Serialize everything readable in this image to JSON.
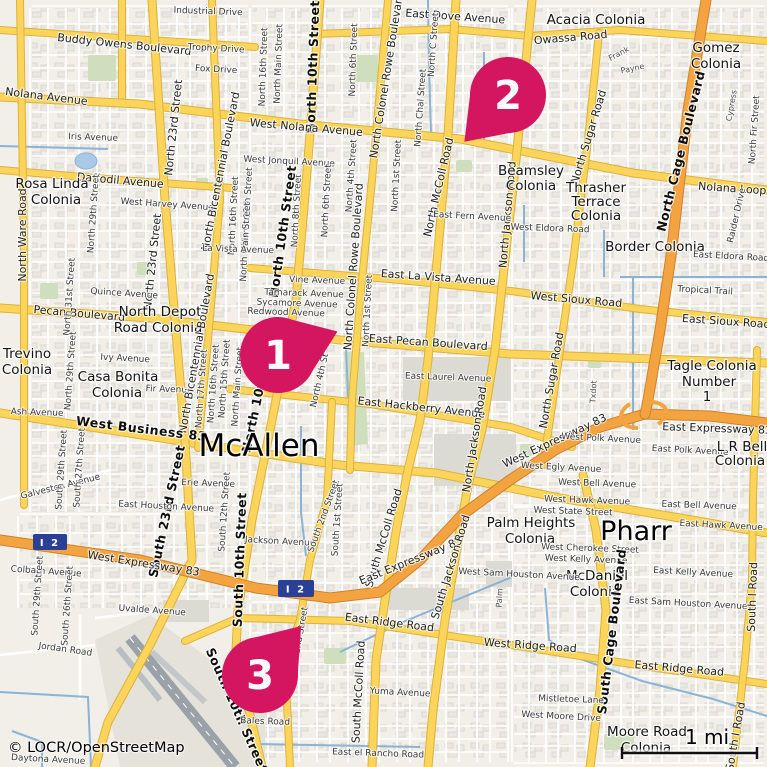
{
  "map": {
    "attribution": "© LOCR/OpenStreetMap",
    "scale_label": "1 mi",
    "shield_label": "I 2",
    "cities": [
      "McAllen",
      "Pharr"
    ],
    "markers": [
      {
        "label": "1"
      },
      {
        "label": "2"
      },
      {
        "label": "3"
      }
    ],
    "colors": {
      "marker": "#d4155f",
      "road_yellow": "#fcd45a",
      "road_orange": "#f3a440",
      "water": "#8ab3d6",
      "park": "#cfdfbe",
      "shield_blue": "#2a3f96",
      "land": "#f2efe9"
    },
    "labels": [
      {
        "t": "Industrial Drive",
        "x": 208,
        "y": 14,
        "r": 2
      },
      {
        "t": "Buddy Owens Boulevard",
        "x": 124,
        "y": 48,
        "r": 6,
        "k": "road"
      },
      {
        "t": "Trophy Drive",
        "x": 216,
        "y": 51,
        "r": 3
      },
      {
        "t": "Fox Drive",
        "x": 216,
        "y": 72,
        "r": 3
      },
      {
        "t": "Nolana Avenue",
        "x": 46,
        "y": 100,
        "r": 7,
        "k": "road"
      },
      {
        "t": "Iris Avenue",
        "x": 93,
        "y": 140,
        "r": 2
      },
      {
        "t": "Daffodil Avenue",
        "x": 120,
        "y": 184,
        "r": 5,
        "k": "road"
      },
      {
        "t": "Rosa Linda",
        "x": 52,
        "y": 188,
        "k": "colonia"
      },
      {
        "t": "Colonia",
        "x": 56,
        "y": 204,
        "k": "colonia"
      },
      {
        "t": "West Harvey Avenue",
        "x": 167,
        "y": 207,
        "r": 4
      },
      {
        "t": "North Ware Road",
        "x": 26,
        "y": 235,
        "r": -90,
        "k": "road"
      },
      {
        "t": "North 29th Street",
        "x": 96,
        "y": 214,
        "r": -86
      },
      {
        "t": "North 23rd Street",
        "x": 177,
        "y": 128,
        "r": -84,
        "k": "road"
      },
      {
        "t": "North 23rd Street",
        "x": 156,
        "y": 262,
        "r": -84,
        "k": "road"
      },
      {
        "t": "North Bicentennial Boulevard",
        "x": 224,
        "y": 172,
        "r": -79,
        "k": "road"
      },
      {
        "t": "North 16th Street",
        "x": 266,
        "y": 67,
        "r": -88
      },
      {
        "t": "North Main Street",
        "x": 281,
        "y": 64,
        "r": -88
      },
      {
        "t": "North 10th Street",
        "x": 317,
        "y": 67,
        "r": -88,
        "k": "bold"
      },
      {
        "t": "North 6th Street",
        "x": 356,
        "y": 60,
        "r": -88
      },
      {
        "t": "North Colonel Rowe Boulevard",
        "x": 390,
        "y": 76,
        "r": -81,
        "k": "road"
      },
      {
        "t": "East Dove Avenue",
        "x": 455,
        "y": 20,
        "r": 4,
        "k": "road"
      },
      {
        "t": "North C Street",
        "x": 436,
        "y": 45,
        "r": -86
      },
      {
        "t": "North Chal Street",
        "x": 423,
        "y": 108,
        "r": -86
      },
      {
        "t": "North McColl Road",
        "x": 442,
        "y": 188,
        "r": -77,
        "k": "road"
      },
      {
        "t": "Acacia Colonia",
        "x": 596,
        "y": 24,
        "k": "colonia"
      },
      {
        "t": "Owassa Road",
        "x": 571,
        "y": 41,
        "r": -5,
        "k": "road"
      },
      {
        "t": "Gomez",
        "x": 716,
        "y": 52,
        "k": "colonia"
      },
      {
        "t": "Colonia",
        "x": 716,
        "y": 68,
        "k": "colonia"
      },
      {
        "t": "Frank",
        "x": 620,
        "y": 56,
        "r": -28,
        "k": "small"
      },
      {
        "t": "Payne",
        "x": 633,
        "y": 71,
        "r": -12,
        "k": "small"
      },
      {
        "t": "North Cage Boulevard",
        "x": 685,
        "y": 152,
        "r": -76,
        "k": "bold"
      },
      {
        "t": "Cypress",
        "x": 734,
        "y": 106,
        "r": -80,
        "k": "small"
      },
      {
        "t": "North Fir Street",
        "x": 757,
        "y": 130,
        "r": -86
      },
      {
        "t": "North Sugar Road",
        "x": 592,
        "y": 138,
        "r": -73,
        "k": "road"
      },
      {
        "t": "North Jackson Road",
        "x": 511,
        "y": 215,
        "r": -85,
        "k": "road"
      },
      {
        "t": "West Nolana Avenue",
        "x": 306,
        "y": 131,
        "r": 5,
        "k": "road"
      },
      {
        "t": "West Jonquil Avenue",
        "x": 289,
        "y": 164,
        "r": 3
      },
      {
        "t": "North 12th Street",
        "x": 250,
        "y": 207,
        "r": -87
      },
      {
        "t": "North 16th Street",
        "x": 236,
        "y": 216,
        "r": -87
      },
      {
        "t": "North Main Street",
        "x": 248,
        "y": 242,
        "r": -87
      },
      {
        "t": "North 8th Street",
        "x": 299,
        "y": 211,
        "r": -87
      },
      {
        "t": "North 6th Street",
        "x": 329,
        "y": 201,
        "r": -87
      },
      {
        "t": "North 4th Street",
        "x": 354,
        "y": 176,
        "r": -86
      },
      {
        "t": "North 1st Street",
        "x": 399,
        "y": 176,
        "r": -87
      },
      {
        "t": "North 10th Street",
        "x": 287,
        "y": 232,
        "r": -82,
        "k": "bold"
      },
      {
        "t": "East Fern Avenue",
        "x": 472,
        "y": 219,
        "r": 3
      },
      {
        "t": "Beamsley",
        "x": 531,
        "y": 175,
        "k": "colonia"
      },
      {
        "t": "Colonia",
        "x": 531,
        "y": 190,
        "k": "colonia"
      },
      {
        "t": "Thrasher",
        "x": 596,
        "y": 192,
        "k": "colonia"
      },
      {
        "t": "Terrace",
        "x": 596,
        "y": 206,
        "k": "colonia"
      },
      {
        "t": "Colonia",
        "x": 596,
        "y": 220,
        "k": "colonia"
      },
      {
        "t": "Nolana Loop",
        "x": 732,
        "y": 192,
        "r": 4,
        "k": "road"
      },
      {
        "t": "Raider Drive",
        "x": 739,
        "y": 216,
        "r": -77
      },
      {
        "t": "West Eldora Road",
        "x": 550,
        "y": 231,
        "r": 2
      },
      {
        "t": "Border Colonia",
        "x": 655,
        "y": 251,
        "k": "colonia"
      },
      {
        "t": "East Eldora Road",
        "x": 731,
        "y": 259,
        "r": 3
      },
      {
        "t": "Tropical Trail",
        "x": 705,
        "y": 293,
        "r": 3
      },
      {
        "t": "La Vista Avenue",
        "x": 238,
        "y": 252,
        "r": 2
      },
      {
        "t": "Vine Avenue",
        "x": 317,
        "y": 283,
        "r": 2
      },
      {
        "t": "Tamarack Avenue",
        "x": 304,
        "y": 296,
        "r": 2
      },
      {
        "t": "Sycamore Avenue",
        "x": 297,
        "y": 306,
        "r": 2
      },
      {
        "t": "Redwood Avenue",
        "x": 286,
        "y": 315,
        "r": 2
      },
      {
        "t": "East La Vista Avenue",
        "x": 438,
        "y": 281,
        "r": 4,
        "k": "road"
      },
      {
        "t": "North 1st Street",
        "x": 370,
        "y": 311,
        "r": -87
      },
      {
        "t": "North Colonel Rowe Boulevard",
        "x": 357,
        "y": 267,
        "r": -86,
        "k": "road"
      },
      {
        "t": "West Sioux Road",
        "x": 576,
        "y": 303,
        "r": 5,
        "k": "road"
      },
      {
        "t": "East Sioux Road",
        "x": 726,
        "y": 325,
        "r": 4,
        "k": "road"
      },
      {
        "t": "North Sugar Road",
        "x": 555,
        "y": 381,
        "r": -80,
        "k": "road"
      },
      {
        "t": "Quince Avenue",
        "x": 124,
        "y": 296,
        "r": 4
      },
      {
        "t": "Pecan Boulevard",
        "x": 79,
        "y": 317,
        "r": 5,
        "k": "road"
      },
      {
        "t": "North Depot",
        "x": 160,
        "y": 316,
        "k": "colonia"
      },
      {
        "t": "Road Colonia",
        "x": 158,
        "y": 332,
        "k": "colonia"
      },
      {
        "t": "North 31st Street",
        "x": 72,
        "y": 297,
        "r": -86
      },
      {
        "t": "Trevino",
        "x": 27,
        "y": 358,
        "k": "colonia"
      },
      {
        "t": "Colonia",
        "x": 27,
        "y": 374,
        "k": "colonia"
      },
      {
        "t": "North 29th Street",
        "x": 73,
        "y": 371,
        "r": -86
      },
      {
        "t": "Casa Bonita",
        "x": 118,
        "y": 381,
        "k": "colonia"
      },
      {
        "t": "Colonia",
        "x": 117,
        "y": 397,
        "k": "colonia"
      },
      {
        "t": "Ivy Avenue",
        "x": 125,
        "y": 361,
        "r": 3
      },
      {
        "t": "Fir Avenue",
        "x": 169,
        "y": 392,
        "r": 2
      },
      {
        "t": "North Bicentennial Boulevard",
        "x": 200,
        "y": 354,
        "r": -80,
        "k": "road"
      },
      {
        "t": "North 17th Street",
        "x": 204,
        "y": 389,
        "r": -86
      },
      {
        "t": "North 16th Street",
        "x": 216,
        "y": 384,
        "r": -86
      },
      {
        "t": "North 15th Street",
        "x": 227,
        "y": 379,
        "r": -86
      },
      {
        "t": "North Main Street",
        "x": 240,
        "y": 387,
        "r": -86
      },
      {
        "t": "North 10th Street",
        "x": 264,
        "y": 388,
        "r": -78,
        "k": "bold"
      },
      {
        "t": "North 4th St",
        "x": 322,
        "y": 381,
        "r": -77
      },
      {
        "t": "East Pecan Boulevard",
        "x": 428,
        "y": 346,
        "r": 4,
        "k": "road"
      },
      {
        "t": "East Laurel Avenue",
        "x": 448,
        "y": 380,
        "r": 2
      },
      {
        "t": "East Hackberry Avenue",
        "x": 421,
        "y": 411,
        "r": 6,
        "k": "road"
      },
      {
        "t": "North Jackson Road",
        "x": 478,
        "y": 440,
        "r": -81,
        "k": "road"
      },
      {
        "t": "Tagle Colonia",
        "x": 712,
        "y": 370,
        "k": "colonia"
      },
      {
        "t": "Number",
        "x": 709,
        "y": 386,
        "k": "colonia"
      },
      {
        "t": "1",
        "x": 707,
        "y": 401,
        "k": "colonia"
      },
      {
        "t": "Txdot",
        "x": 596,
        "y": 392,
        "r": -87,
        "k": "small"
      },
      {
        "t": "Ash Avenue",
        "x": 37,
        "y": 415,
        "r": 2
      },
      {
        "t": "West Business 83",
        "x": 141,
        "y": 433,
        "r": 7,
        "k": "bold"
      },
      {
        "t": "McAllen",
        "x": 259,
        "y": 456,
        "k": "city"
      },
      {
        "t": "Galveston Avenue",
        "x": 61,
        "y": 489,
        "r": -14
      },
      {
        "t": "South 29th Street",
        "x": 64,
        "y": 470,
        "r": -86
      },
      {
        "t": "South 27th Street",
        "x": 82,
        "y": 468,
        "r": -86
      },
      {
        "t": "South 23rd Street",
        "x": 171,
        "y": 512,
        "r": -78,
        "k": "bold"
      },
      {
        "t": "Erie Avenue",
        "x": 208,
        "y": 486,
        "r": 2
      },
      {
        "t": "East Houston Avenue",
        "x": 166,
        "y": 509,
        "r": 3
      },
      {
        "t": "South 12th Street",
        "x": 227,
        "y": 512,
        "r": -86
      },
      {
        "t": "South 10th Street",
        "x": 244,
        "y": 560,
        "r": -88,
        "k": "bold"
      },
      {
        "t": "Jackson Avenue",
        "x": 280,
        "y": 544,
        "r": 3
      },
      {
        "t": "South 2nd Street",
        "x": 326,
        "y": 517,
        "r": -70
      },
      {
        "t": "South 1st Street",
        "x": 340,
        "y": 520,
        "r": -86
      },
      {
        "t": "South McColl Road",
        "x": 387,
        "y": 539,
        "r": -73,
        "k": "road"
      },
      {
        "t": "West Expressway 83",
        "x": 143,
        "y": 567,
        "r": 9,
        "k": "road"
      },
      {
        "t": "East Expressway 83",
        "x": 412,
        "y": 564,
        "r": -22,
        "k": "road"
      },
      {
        "t": "West Expressway 83",
        "x": 556,
        "y": 444,
        "r": -25,
        "k": "road"
      },
      {
        "t": "East Expressway 83",
        "x": 717,
        "y": 432,
        "r": 2,
        "k": "road"
      },
      {
        "t": "West Polk Avenue",
        "x": 601,
        "y": 441,
        "r": 3
      },
      {
        "t": "East Polk Avenue",
        "x": 690,
        "y": 453,
        "r": 3
      },
      {
        "t": "L R Bell",
        "x": 742,
        "y": 451,
        "k": "colonia"
      },
      {
        "t": "Colonia",
        "x": 740,
        "y": 465,
        "k": "colonia"
      },
      {
        "t": "West Egly Avenue",
        "x": 561,
        "y": 470,
        "r": 3
      },
      {
        "t": "West Bell Avenue",
        "x": 597,
        "y": 486,
        "r": 2
      },
      {
        "t": "East Bell Avenue",
        "x": 699,
        "y": 508,
        "r": 2
      },
      {
        "t": "West Hawk Avenue",
        "x": 587,
        "y": 503,
        "r": 2
      },
      {
        "t": "East Hawk Avenue",
        "x": 721,
        "y": 528,
        "r": 3
      },
      {
        "t": "West State Street",
        "x": 573,
        "y": 514,
        "r": 2
      },
      {
        "t": "Palm Heights",
        "x": 531,
        "y": 527,
        "k": "colonia"
      },
      {
        "t": "Colonia",
        "x": 530,
        "y": 543,
        "k": "colonia"
      },
      {
        "t": "Pharr",
        "x": 636,
        "y": 540,
        "k": "city2"
      },
      {
        "t": "West Cherokee Street",
        "x": 590,
        "y": 551,
        "r": 2
      },
      {
        "t": "West Kelly Avenue",
        "x": 586,
        "y": 562,
        "r": 2
      },
      {
        "t": "East Kelly Avenue",
        "x": 693,
        "y": 575,
        "r": 3
      },
      {
        "t": "McDaniel",
        "x": 597,
        "y": 580,
        "k": "colonia"
      },
      {
        "t": "Colonia",
        "x": 595,
        "y": 596,
        "k": "colonia"
      },
      {
        "t": "East Sam Houston Avenue",
        "x": 688,
        "y": 606,
        "r": 3
      },
      {
        "t": "West Sam Houston Avenue",
        "x": 519,
        "y": 577,
        "r": 3
      },
      {
        "t": "Palm",
        "x": 502,
        "y": 598,
        "r": -87,
        "k": "small"
      },
      {
        "t": "South Jackson Road",
        "x": 454,
        "y": 568,
        "r": -73,
        "k": "road"
      },
      {
        "t": "South McColl Road",
        "x": 362,
        "y": 692,
        "r": -87,
        "k": "road"
      },
      {
        "t": "Colbath Avenue",
        "x": 46,
        "y": 574,
        "r": 4
      },
      {
        "t": "South 29th Street",
        "x": 40,
        "y": 596,
        "r": -86
      },
      {
        "t": "South 26th Street",
        "x": 70,
        "y": 606,
        "r": -86
      },
      {
        "t": "Jordan Road",
        "x": 65,
        "y": 652,
        "r": 8
      },
      {
        "t": "Uvalde Avenue",
        "x": 152,
        "y": 613,
        "r": 4
      },
      {
        "t": "South 10th Street",
        "x": 233,
        "y": 712,
        "r": 66,
        "k": "bold"
      },
      {
        "t": "South 2nd Street",
        "x": 301,
        "y": 645,
        "r": -80
      },
      {
        "t": "East Ridge Road",
        "x": 389,
        "y": 626,
        "r": 7,
        "k": "road"
      },
      {
        "t": "West Ridge Road",
        "x": 530,
        "y": 649,
        "r": 4,
        "k": "road"
      },
      {
        "t": "East Ridge Road",
        "x": 679,
        "y": 672,
        "r": 5,
        "k": "road"
      },
      {
        "t": "South Cage Boulevard",
        "x": 616,
        "y": 632,
        "r": -83,
        "k": "bold"
      },
      {
        "t": "South I Road",
        "x": 756,
        "y": 597,
        "r": -88,
        "k": "road"
      },
      {
        "t": "South I Road",
        "x": 739,
        "y": 737,
        "r": -80,
        "k": "road"
      },
      {
        "t": "Yuma Avenue",
        "x": 400,
        "y": 695,
        "r": 3
      },
      {
        "t": "Mistletoe Lane",
        "x": 571,
        "y": 702,
        "r": 2
      },
      {
        "t": "West Moore Drive",
        "x": 561,
        "y": 719,
        "r": 3
      },
      {
        "t": "Moore Road",
        "x": 647,
        "y": 736,
        "k": "colonia"
      },
      {
        "t": "Colonia",
        "x": 646,
        "y": 752,
        "k": "colonia"
      },
      {
        "t": "Bales Road",
        "x": 265,
        "y": 724,
        "r": 2
      },
      {
        "t": "East el Rancho Road",
        "x": 378,
        "y": 756,
        "r": 2
      },
      {
        "t": "Daytona Avenue",
        "x": 48,
        "y": 762,
        "r": 3
      }
    ]
  }
}
